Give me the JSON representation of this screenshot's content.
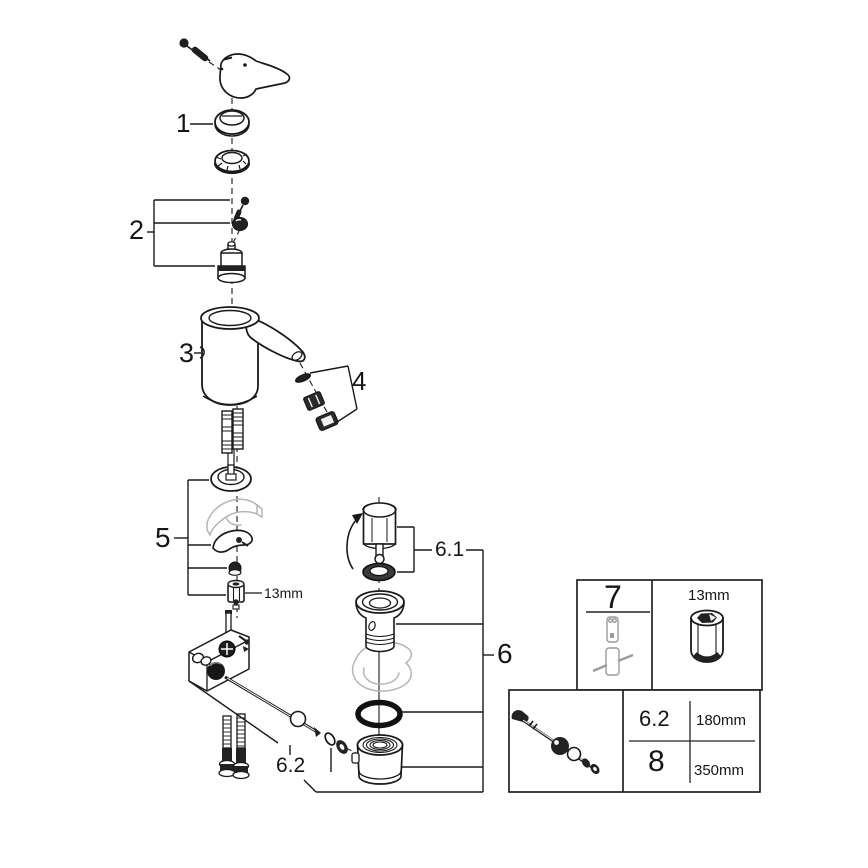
{
  "diagram": {
    "type": "exploded-parts-diagram",
    "subject": "single-lever basin faucet with pop-up waste",
    "line_color": "#1a1a1a",
    "ghost_color": "#b5b5b5",
    "callouts": {
      "p1": "1",
      "p2": "2",
      "p3": "3",
      "p4": "4",
      "p5": "5",
      "p6": "6",
      "p61": "6.1",
      "p62": "6.2"
    },
    "notes": {
      "deck_nut_size": "13mm"
    },
    "tables": {
      "tool": {
        "ref": "7",
        "socket_size": "13mm"
      },
      "rods": {
        "rows": [
          {
            "ref": "6.2",
            "length": "180mm"
          },
          {
            "ref": "8",
            "length": "350mm"
          }
        ]
      }
    }
  }
}
